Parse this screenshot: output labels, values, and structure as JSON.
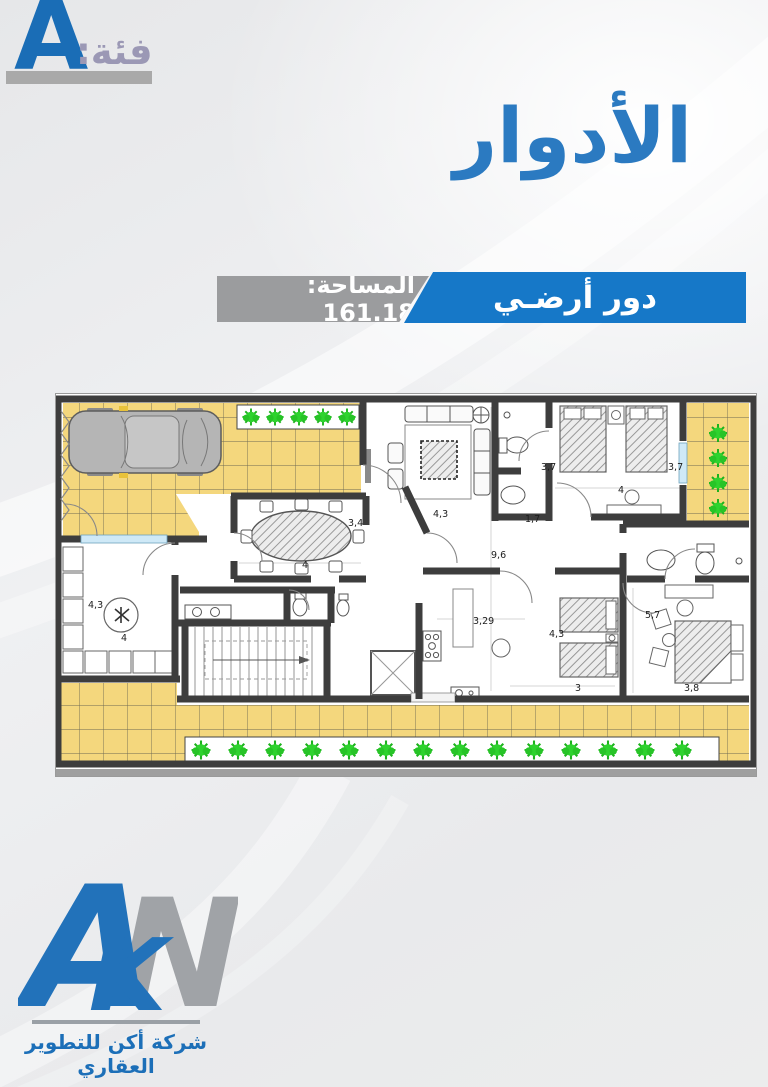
{
  "header": {
    "category_label": "فئة:",
    "category_value": "A",
    "title": "الأدوار"
  },
  "banner": {
    "floor_name": "دور أرضـي",
    "area_label": "المساحة: 161.18"
  },
  "colors": {
    "title_blue": "#2b7ac1",
    "banner_blue": "#1678c8",
    "banner_gray": "#9b9c9e",
    "category_letter_blue": "#1a6db6",
    "category_label_gray": "#9b98b5",
    "logo_blue": "#2272ba",
    "logo_gray": "#a0a3a7",
    "tile_yellow": "#f4d77d",
    "plant_green": "#2cc52c",
    "wall_gray": "#414141"
  },
  "floor_plan": {
    "dimensions": [
      {
        "label": "3,4",
        "x": 293,
        "y": 133
      },
      {
        "label": "4",
        "x": 247,
        "y": 175
      },
      {
        "label": "4,3",
        "x": 378,
        "y": 124
      },
      {
        "label": "9,6",
        "x": 436,
        "y": 165
      },
      {
        "label": "3,7",
        "x": 486,
        "y": 77
      },
      {
        "label": "1,7",
        "x": 470,
        "y": 129
      },
      {
        "label": "3,7",
        "x": 613,
        "y": 77
      },
      {
        "label": "4",
        "x": 563,
        "y": 100
      },
      {
        "label": "4,3",
        "x": 33,
        "y": 215
      },
      {
        "label": "4",
        "x": 66,
        "y": 248
      },
      {
        "label": "3,29",
        "x": 418,
        "y": 231
      },
      {
        "label": "4,3",
        "x": 494,
        "y": 244
      },
      {
        "label": "3",
        "x": 520,
        "y": 298
      },
      {
        "label": "5,7",
        "x": 590,
        "y": 225
      },
      {
        "label": "3,8",
        "x": 629,
        "y": 298
      }
    ]
  },
  "footer": {
    "logo_letters": {
      "a": "A",
      "k": "K",
      "n": "N"
    },
    "company_name": "شركة أكن للتطوير العقاري"
  }
}
